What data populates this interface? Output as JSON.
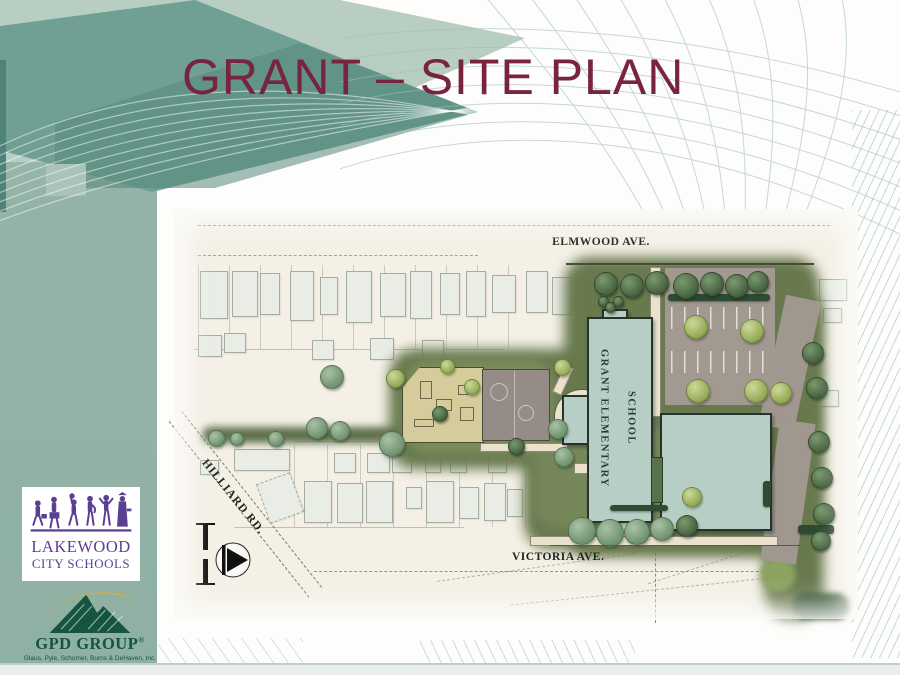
{
  "slide": {
    "title": "GRANT – SITE PLAN"
  },
  "site_plan": {
    "streets": {
      "elmwood": "ELMWOOD AVE.",
      "victoria": "VICTORIA AVE.",
      "hilliard": "HILLIARD RD."
    },
    "school_label": "GRANT ELEMENTARY SCHOOL"
  },
  "logos": {
    "lakewood": {
      "line1": "LAKEWOOD",
      "line2": "CITY SCHOOLS"
    },
    "gpd": {
      "name": "GPD GROUP",
      "registered": "®",
      "tagline": "Glaus, Pyle, Schomer, Burns & DeHaven, Inc."
    }
  },
  "colors": {
    "title_maroon": "#78243f",
    "deco_teal": "#6fa093",
    "band_sage": "#94b3a7",
    "plan_paper": "#f4f0e6",
    "lawn_green": "#68794e",
    "building": "#b7cec5",
    "parking": "#a29991",
    "playground_tan": "#d6cc9b",
    "lakewood_purple": "#5b3f93",
    "gpd_green": "#15543f",
    "gpd_gold": "#f2a71d"
  }
}
